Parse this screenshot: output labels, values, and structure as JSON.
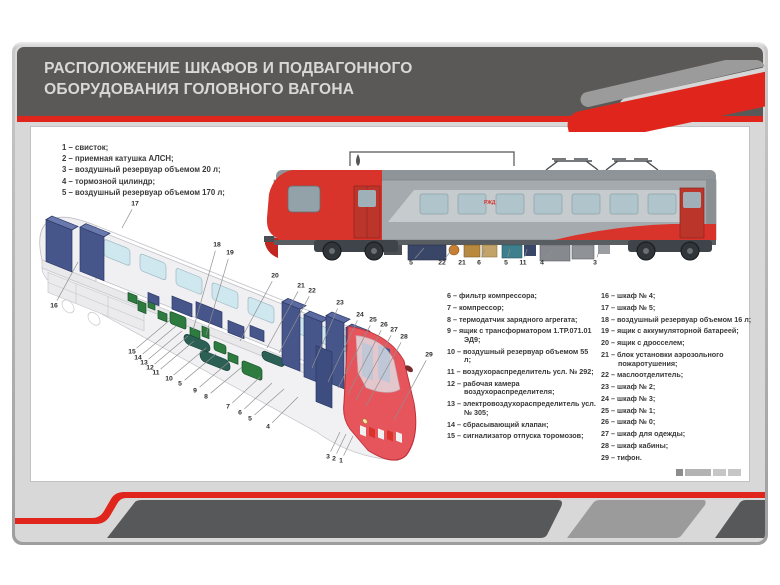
{
  "header": {
    "title_line1": "РАСПОЛОЖЕНИЕ ШКАФОВ И ПОДВАГОННОГО",
    "title_line2": "ОБОРУДОВАНИЯ ГОЛОВНОГО ВАГОНА"
  },
  "colors": {
    "accent_red": "#e0261c",
    "header_gray": "#5b5957",
    "footer_dark": "#57585a",
    "cabinet_navy": "#46558a",
    "equipment_green": "#2e7b3f",
    "reservoir_teal": "#2c6055"
  },
  "train": {
    "logo": "РЖД"
  },
  "legend_left": [
    "1 – свисток;",
    "2 – приемная катушка АЛСН;",
    "3 – воздушный резервуар объемом 20 л;",
    "4 – тормозной цилиндр;",
    "5 – воздушный резервуар объемом 170 л;"
  ],
  "legend_middle": [
    "6 – фильтр компрессора;",
    "7 – компрессор;",
    "8 – термодатчик зарядного агрегата;",
    "9 – ящик с трансформатором 1.ТР.071.01 ЭД9;",
    "10 – воздушный резервуар объемом 55 л;",
    "11 – воздухораспределитель усл. № 292;",
    "12 – рабочая камера воздухораспределителя;",
    "13 – электровоздухораспределитель усл. № 305;",
    "14 – сбрасывающий клапан;",
    "15 – сигнализатор отпуска торомозов;"
  ],
  "legend_right": [
    "16 – шкаф № 4;",
    "17 – шкаф № 5;",
    "18 – воздушный резервуар объемом 16 л;",
    "19 – ящик с аккумуляторной батареей;",
    "20 – ящик с дросселем;",
    "21 – блок установки аэрозольного пожаротушения;",
    "22 – маслоотделитель;",
    "23 – шкаф № 2;",
    "24 – шкаф № 3;",
    "25 – шкаф № 1;",
    "26 – шкаф № 0;",
    "27 – шкаф для одежды;",
    "28 – шкаф кабины;",
    "29 – тифон."
  ],
  "train_callouts": [
    {
      "n": "5",
      "x": 411,
      "y": 263,
      "tx": 424,
      "ty": 248
    },
    {
      "n": "22",
      "x": 442,
      "y": 263,
      "tx": 452,
      "ty": 249
    },
    {
      "n": "21",
      "x": 462,
      "y": 263,
      "tx": 468,
      "ty": 249
    },
    {
      "n": "6",
      "x": 479,
      "y": 263,
      "tx": 485,
      "ty": 249
    },
    {
      "n": "5",
      "x": 506,
      "y": 263,
      "tx": 510,
      "ty": 249
    },
    {
      "n": "11",
      "x": 523,
      "y": 263,
      "tx": 527,
      "ty": 249
    },
    {
      "n": "4",
      "x": 542,
      "y": 263,
      "tx": 552,
      "ty": 250
    },
    {
      "n": "3",
      "x": 595,
      "y": 263,
      "tx": 600,
      "ty": 249
    }
  ],
  "cutaway_callouts": [
    {
      "n": "17",
      "x": 135,
      "y": 204,
      "tx": 122,
      "ty": 228
    },
    {
      "n": "16",
      "x": 54,
      "y": 306,
      "tx": 78,
      "ty": 262
    },
    {
      "n": "18",
      "x": 217,
      "y": 245,
      "tx": 193,
      "ty": 330
    },
    {
      "n": "19",
      "x": 230,
      "y": 253,
      "tx": 206,
      "ty": 335
    },
    {
      "n": "20",
      "x": 275,
      "y": 276,
      "tx": 240,
      "ty": 341
    },
    {
      "n": "21",
      "x": 301,
      "y": 286,
      "tx": 267,
      "ty": 348
    },
    {
      "n": "22",
      "x": 312,
      "y": 291,
      "tx": 279,
      "ty": 353
    },
    {
      "n": "23",
      "x": 340,
      "y": 303,
      "tx": 312,
      "ty": 368
    },
    {
      "n": "24",
      "x": 360,
      "y": 315,
      "tx": 328,
      "ty": 382
    },
    {
      "n": "25",
      "x": 373,
      "y": 320,
      "tx": 338,
      "ty": 388
    },
    {
      "n": "26",
      "x": 384,
      "y": 325,
      "tx": 348,
      "ty": 394
    },
    {
      "n": "27",
      "x": 394,
      "y": 330,
      "tx": 356,
      "ty": 400
    },
    {
      "n": "28",
      "x": 404,
      "y": 337,
      "tx": 366,
      "ty": 406
    },
    {
      "n": "29",
      "x": 429,
      "y": 355,
      "tx": 394,
      "ty": 420
    },
    {
      "n": "15",
      "x": 132,
      "y": 352,
      "tx": 170,
      "ty": 320
    },
    {
      "n": "14",
      "x": 138,
      "y": 358,
      "tx": 176,
      "ty": 326
    },
    {
      "n": "13",
      "x": 144,
      "y": 363,
      "tx": 182,
      "ty": 331
    },
    {
      "n": "12",
      "x": 150,
      "y": 368,
      "tx": 188,
      "ty": 336
    },
    {
      "n": "11",
      "x": 156,
      "y": 373,
      "tx": 194,
      "ty": 341
    },
    {
      "n": "10",
      "x": 169,
      "y": 379,
      "tx": 206,
      "ty": 348
    },
    {
      "n": "5",
      "x": 180,
      "y": 384,
      "tx": 216,
      "ty": 354
    },
    {
      "n": "9",
      "x": 195,
      "y": 391,
      "tx": 230,
      "ty": 361
    },
    {
      "n": "8",
      "x": 206,
      "y": 397,
      "tx": 242,
      "ty": 367
    },
    {
      "n": "7",
      "x": 228,
      "y": 407,
      "tx": 260,
      "ty": 377
    },
    {
      "n": "6",
      "x": 240,
      "y": 413,
      "tx": 272,
      "ty": 383
    },
    {
      "n": "5",
      "x": 250,
      "y": 419,
      "tx": 284,
      "ty": 389
    },
    {
      "n": "4",
      "x": 268,
      "y": 427,
      "tx": 298,
      "ty": 397
    },
    {
      "n": "3",
      "x": 328,
      "y": 457,
      "tx": 340,
      "ty": 432
    },
    {
      "n": "2",
      "x": 334,
      "y": 459,
      "tx": 346,
      "ty": 434
    },
    {
      "n": "1",
      "x": 341,
      "y": 461,
      "tx": 353,
      "ty": 436
    }
  ]
}
